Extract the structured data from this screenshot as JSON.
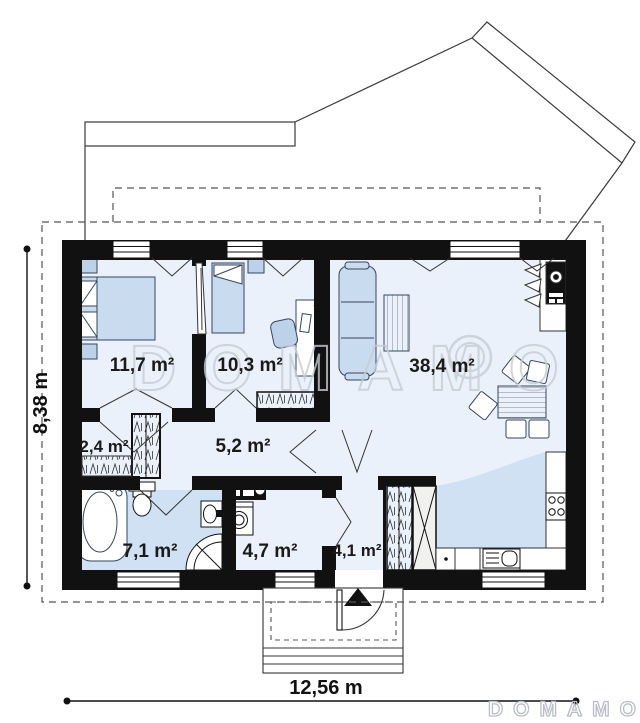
{
  "plan": {
    "title": "house-floor-plan",
    "watermark": {
      "center": "DOMAMO",
      "corner": "DOMAMO"
    },
    "dimensions": {
      "width": "12,56 m",
      "height": "8,38 m"
    },
    "rooms": [
      {
        "name": "bedroom-1",
        "area": "11,7 m²"
      },
      {
        "name": "bedroom-2",
        "area": "10,3 m²"
      },
      {
        "name": "living-room",
        "area": "38,4 m²"
      },
      {
        "name": "closet",
        "area": "2,4 m²"
      },
      {
        "name": "hallway",
        "area": "5,2 m²"
      },
      {
        "name": "bathroom",
        "area": "7,1 m²"
      },
      {
        "name": "utility-room",
        "area": "4,7 m²"
      },
      {
        "name": "entry-hall",
        "area": "4,1 m²"
      }
    ],
    "colors": {
      "wall": "#111111",
      "floor": "#eaf1fa",
      "wet_floor": "#cfe1f3",
      "furniture_fill": "#c9dbef",
      "watermark": "#c7ccd3"
    }
  }
}
